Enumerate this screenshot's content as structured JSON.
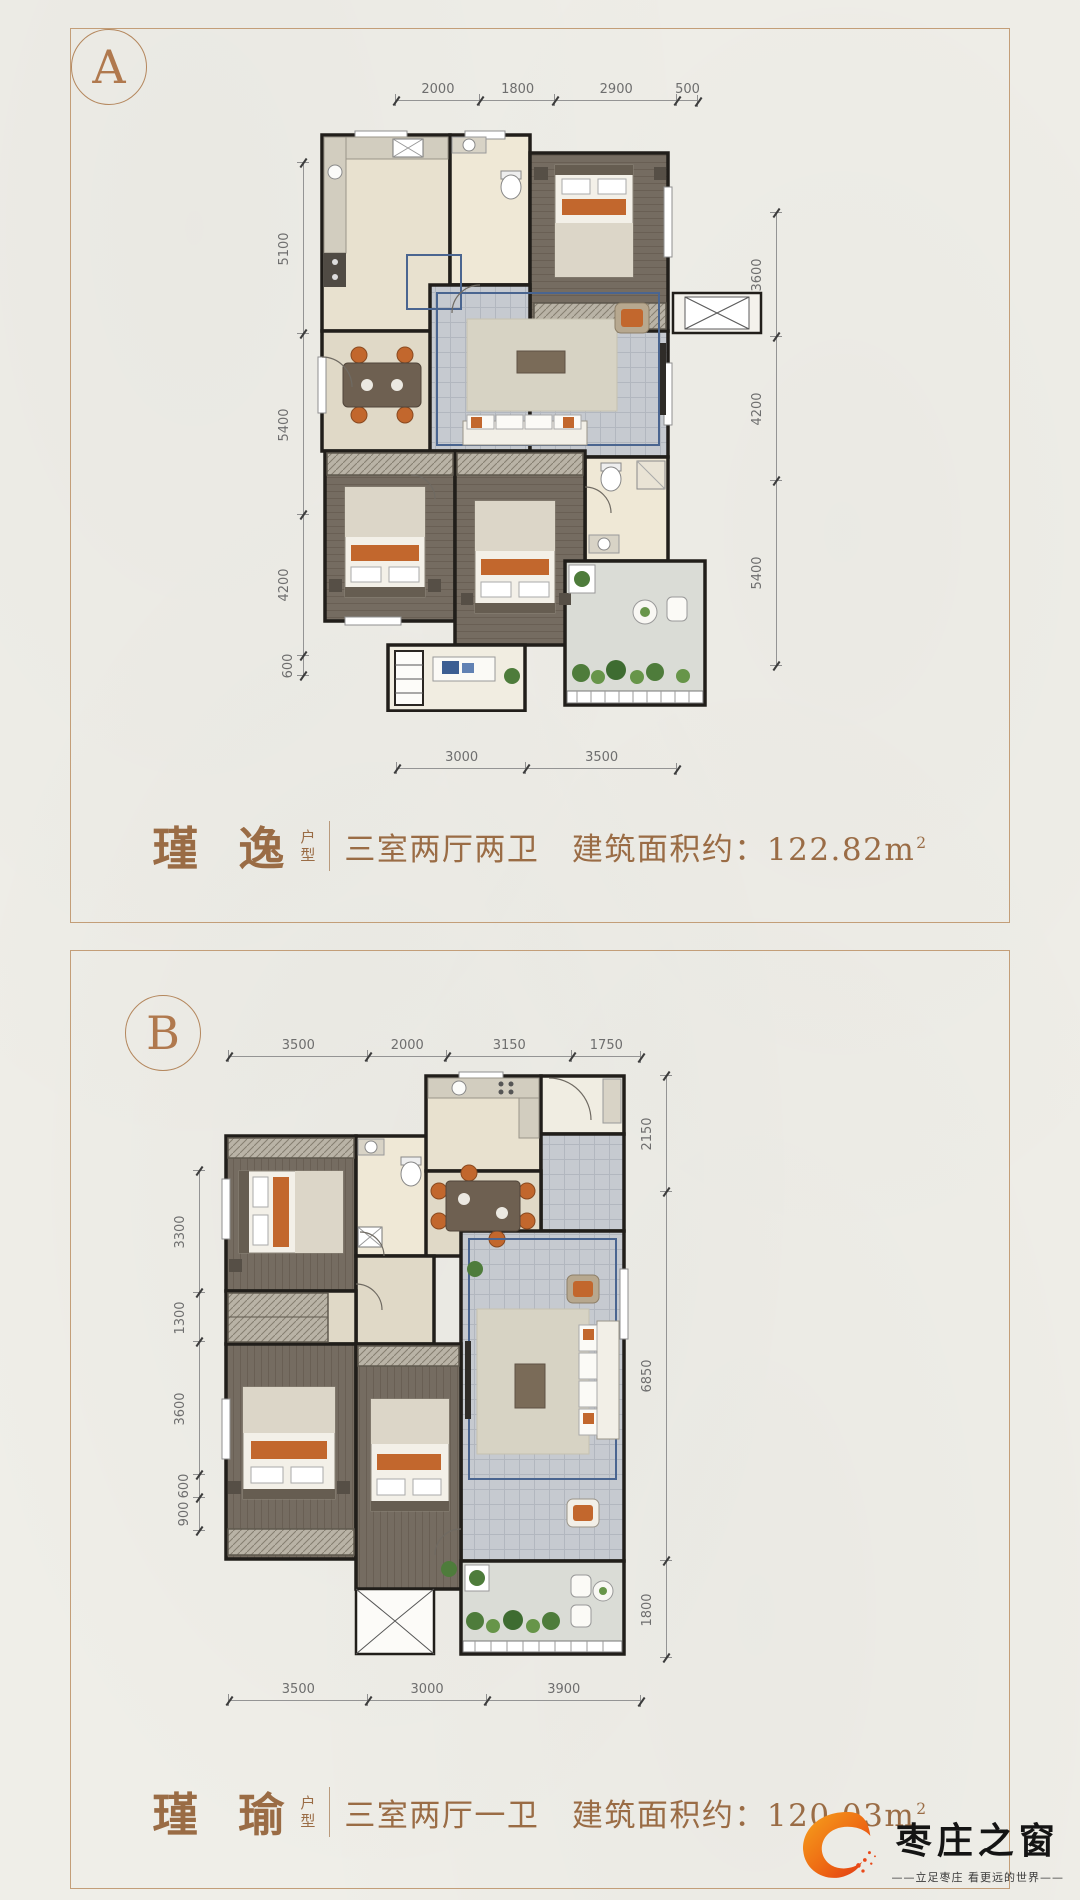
{
  "page": {
    "background": "#efeee8",
    "accent": "#9a6c45"
  },
  "panels": [
    {
      "label": "A",
      "name": "瑾 逸",
      "type_chars": [
        "户",
        "型"
      ],
      "desc": "三室两厅两卫　建筑面积约：122.82m",
      "area_sup": "2",
      "dims": {
        "top": [
          "2000",
          "1800",
          "2900",
          "500"
        ],
        "left": [
          "5100",
          "5400",
          "4200",
          "600"
        ],
        "right": [
          "3600",
          "4200",
          "5400"
        ],
        "bottom": [
          "3000",
          "3500"
        ]
      }
    },
    {
      "label": "B",
      "name": "瑾 瑜",
      "type_chars": [
        "户",
        "型"
      ],
      "desc": "三室两厅一卫　建筑面积约：120.03m",
      "area_sup": "2",
      "dims": {
        "top": [
          "3500",
          "2000",
          "3150",
          "1750"
        ],
        "left": [
          "3300",
          "1300",
          "3600",
          "600",
          "900"
        ],
        "right": [
          "2150",
          "6850",
          "1800"
        ],
        "bottom": [
          "3500",
          "3000",
          "3900"
        ]
      }
    }
  ],
  "logo": {
    "brand": "枣庄之窗",
    "tagline": "——立足枣庄  看更远的世界——"
  }
}
